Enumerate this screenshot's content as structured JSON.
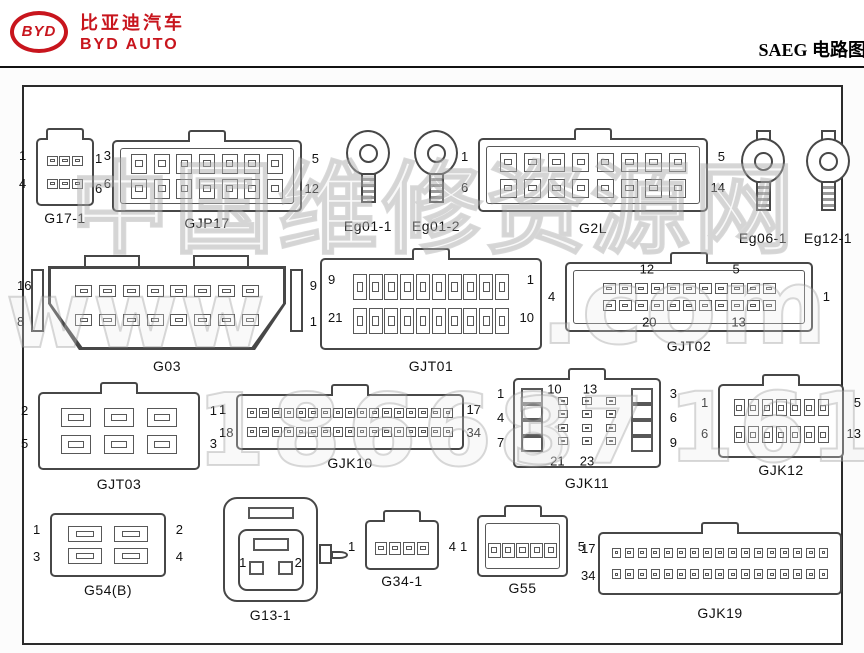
{
  "header": {
    "logo_text": "BYD",
    "brand_cn": "比亚迪汽车",
    "brand_en": "BYD AUTO",
    "title": "SAEG 电路图",
    "brand_color": "#c8151d"
  },
  "colors": {
    "line_art": "#474747",
    "frame_border": "#2b2b2b",
    "text": "#111111",
    "brand_red": "#c8151d",
    "watermark_gray": "#8c8c8c"
  },
  "watermark": {
    "pieces": [
      {
        "text": "中国维修资源网",
        "x": 70,
        "y": 128,
        "size": 100,
        "ls": 4
      },
      {
        "text": "www",
        "x": 6,
        "y": 262,
        "size": 92,
        "ls": 2
      },
      {
        "text": ".com",
        "x": 540,
        "y": 246,
        "size": 104,
        "ls": 2
      },
      {
        "text": "18668",
        "x": 196,
        "y": 372,
        "size": 100,
        "ls": 6
      },
      {
        "text": "37",
        "x": 512,
        "y": 378,
        "size": 92,
        "ls": 4
      },
      {
        "text": "161",
        "x": 668,
        "y": 372,
        "size": 96,
        "ls": 4
      }
    ]
  },
  "connectors": [
    {
      "id": "G17-1",
      "label": "G17-1",
      "type": "grid",
      "x": 36,
      "y": 138,
      "w": 58,
      "h": 68,
      "rows": 2,
      "cols": 3,
      "pin": [
        11,
        10
      ],
      "tab": true,
      "pinInset": "9px 8px",
      "nums": {
        "tl": "1",
        "tr": "3",
        "bl": "4",
        "br": "6"
      },
      "capdy": 4
    },
    {
      "id": "GJP17",
      "label": "GJP17",
      "type": "grid",
      "x": 112,
      "y": 140,
      "w": 190,
      "h": 72,
      "rows": 2,
      "cols": 7,
      "pin": [
        16,
        20
      ],
      "tab": true,
      "innerBox": true,
      "pinInset": "9px 14px",
      "nums": {
        "tl": "1",
        "tr": "5",
        "bl": "6",
        "br": "12"
      },
      "capdy": 3
    },
    {
      "id": "Eg01-1",
      "label": "Eg01-1",
      "type": "ring",
      "x": 340,
      "y": 130,
      "w": 56,
      "h": 84,
      "capdy": 4
    },
    {
      "id": "Eg01-2",
      "label": "Eg01-2",
      "type": "ring",
      "x": 408,
      "y": 130,
      "w": 56,
      "h": 84,
      "capdy": 4
    },
    {
      "id": "G2L",
      "label": "G2L",
      "type": "grid",
      "x": 478,
      "y": 138,
      "w": 230,
      "h": 74,
      "rows": 2,
      "cols": 8,
      "pin": [
        17,
        19
      ],
      "tab": true,
      "innerBox": true,
      "pinInset": "9px 16px",
      "nums": {
        "tl": "1",
        "tr": "5",
        "bl": "6",
        "br": "14"
      },
      "capdy": 8
    },
    {
      "id": "Eg06-1",
      "label": "Eg06-1",
      "type": "ring",
      "variant": "tabbed",
      "x": 734,
      "y": 130,
      "w": 58,
      "h": 90,
      "capdy": 10
    },
    {
      "id": "Eg12-1",
      "label": "Eg12-1",
      "type": "ring",
      "variant": "tabbed",
      "x": 799,
      "y": 130,
      "w": 58,
      "h": 90,
      "capdy": 10
    },
    {
      "id": "G03",
      "label": "G03",
      "type": "grid",
      "trap": true,
      "x": 48,
      "y": 266,
      "w": 238,
      "h": 84,
      "rows": 2,
      "cols": 8,
      "pin": [
        17,
        12
      ],
      "pinInset": "10px 24px 16px",
      "nums": {
        "tl": "16",
        "tr": "9",
        "bl": "8",
        "br": "1"
      },
      "capdy": 8
    },
    {
      "id": "GJT01",
      "label": "GJT01",
      "type": "grid",
      "x": 320,
      "y": 258,
      "w": 222,
      "h": 92,
      "rows": 2,
      "cols": 10,
      "pin": [
        14,
        26
      ],
      "tab": true,
      "numsInside": true,
      "pinInset": "10px 30px",
      "nums": {
        "tl": "9",
        "tr": "1",
        "bl": "21",
        "br": "10"
      },
      "capdy": 8
    },
    {
      "id": "GJT02",
      "label": "GJT02",
      "type": "grid",
      "x": 565,
      "y": 262,
      "w": 248,
      "h": 70,
      "rows": 2,
      "cols": 11,
      "pin": [
        13,
        11
      ],
      "tab": true,
      "innerBox": true,
      "pinInset": "16px 34px",
      "nums": {
        "ml": "4",
        "mr": "1"
      },
      "inner": [
        {
          "t": "12",
          "x": 33,
          "y": 10
        },
        {
          "t": "5",
          "x": 69,
          "y": 10
        },
        {
          "t": "20",
          "x": 34,
          "y": 86
        },
        {
          "t": "13",
          "x": 70,
          "y": 86
        }
      ],
      "capdy": 6
    },
    {
      "id": "GJT03",
      "label": "GJT03",
      "type": "grid",
      "x": 38,
      "y": 392,
      "w": 162,
      "h": 78,
      "rows": 2,
      "cols": 3,
      "pin": [
        30,
        19
      ],
      "tab": true,
      "pinInset": "10px 14px",
      "nums": {
        "tl": "2",
        "tr": "1",
        "bl": "5",
        "br": "3"
      },
      "capdy": 6
    },
    {
      "id": "GJK10",
      "label": "GJK10",
      "type": "grid",
      "x": 236,
      "y": 394,
      "w": 228,
      "h": 56,
      "rows": 2,
      "cols": 17,
      "pin": [
        10,
        10
      ],
      "tab": true,
      "pinInset": "7px 8px",
      "nums": {
        "tl": "1",
        "tr": "17",
        "bl": "18",
        "br": "34"
      },
      "capdy": 5
    },
    {
      "id": "GJK11",
      "label": "GJK11",
      "type": "gjk11",
      "x": 513,
      "y": 378,
      "w": 148,
      "h": 90,
      "tab": true,
      "left_labels": [
        "1",
        "4",
        "7"
      ],
      "right_labels": [
        "3",
        "6",
        "9"
      ],
      "inner": [
        {
          "t": "10",
          "x": 28,
          "y": 12
        },
        {
          "t": "13",
          "x": 52,
          "y": 12
        },
        {
          "t": "21",
          "x": 30,
          "y": 92
        },
        {
          "t": "23",
          "x": 50,
          "y": 92
        }
      ],
      "capdy": 7
    },
    {
      "id": "GJK12",
      "label": "GJK12",
      "type": "grid",
      "x": 718,
      "y": 384,
      "w": 126,
      "h": 74,
      "rows": 2,
      "cols": 7,
      "pin": [
        11,
        17
      ],
      "tab": true,
      "pinInset": "8px 12px",
      "nums": {
        "tl": "1",
        "tr": "5",
        "bl": "6",
        "br": "13"
      },
      "capdy": 4
    },
    {
      "id": "G54B",
      "label": "G54(B)",
      "type": "grid",
      "x": 50,
      "y": 513,
      "w": 116,
      "h": 64,
      "rows": 2,
      "cols": 2,
      "pin": [
        34,
        16
      ],
      "nums": {
        "tl": "1",
        "tr": "2",
        "bl": "3",
        "br": "4"
      },
      "capdy": 5
    },
    {
      "id": "G13-1",
      "label": "G13-1",
      "type": "sq",
      "x": 223,
      "y": 497,
      "w": 95,
      "h": 105,
      "nums": {
        "l": "1",
        "r": "2"
      },
      "capdy": 5
    },
    {
      "id": "G34-1",
      "label": "G34-1",
      "type": "grid",
      "x": 365,
      "y": 520,
      "w": 74,
      "h": 50,
      "rows": 1,
      "cols": 4,
      "pin": [
        12,
        13
      ],
      "tab": true,
      "pinInset": "14px 7px 8px",
      "nums": {
        "ml": "1",
        "mr": "4"
      },
      "capdy": 3
    },
    {
      "id": "G55",
      "label": "G55",
      "type": "grid",
      "x": 477,
      "y": 515,
      "w": 91,
      "h": 62,
      "rows": 1,
      "cols": 5,
      "pin": [
        13,
        15
      ],
      "tab": true,
      "innerBox": true,
      "pinInset": "18px 8px 10px",
      "nums": {
        "ml": "1",
        "mr": "5"
      },
      "capdy": 3
    },
    {
      "id": "GJK19",
      "label": "GJK19",
      "type": "grid",
      "x": 598,
      "y": 532,
      "w": 244,
      "h": 63,
      "rows": 2,
      "cols": 17,
      "pin": [
        9,
        10
      ],
      "tab": true,
      "pinInset": "8px 10px",
      "nums": {
        "tl": "17",
        "bl": "34"
      },
      "capdy": 10
    }
  ]
}
